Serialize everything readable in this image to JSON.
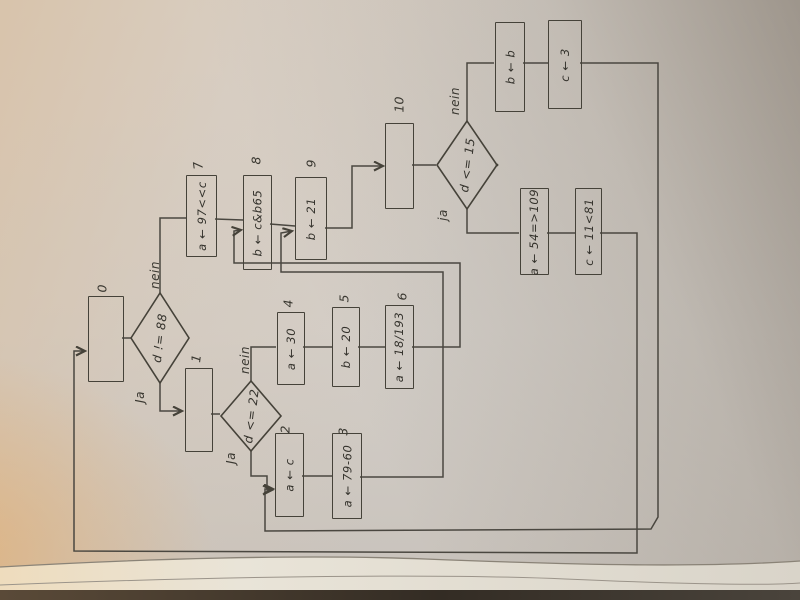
{
  "colors": {
    "ink": "#454239",
    "paper": "#d3cec8"
  },
  "flowchart": {
    "decisions": {
      "d1": {
        "text": "d != 88",
        "yes": "Ja",
        "no": "nein"
      },
      "d2": {
        "text": "d <= 22",
        "yes": "Ja",
        "no": "nein"
      },
      "d3": {
        "text": "d <= 15",
        "yes": "ja",
        "no": "nein"
      }
    },
    "boxes": {
      "b0": {
        "num": "0",
        "text": ""
      },
      "b1": {
        "num": "1",
        "text": ""
      },
      "b2": {
        "num": "2",
        "text": "a ← c"
      },
      "b3": {
        "num": "3",
        "text": "a ← 79-60"
      },
      "b4": {
        "num": "4",
        "text": "a ← 30"
      },
      "b5": {
        "num": "5",
        "text": "b ← 20"
      },
      "b6": {
        "num": "6",
        "text": "a ← 18/193"
      },
      "b7": {
        "num": "7",
        "text": "a ← 97<<c"
      },
      "b8": {
        "num": "8",
        "text": "b ← c&b65"
      },
      "b9": {
        "num": "9",
        "text": "b ← 21"
      },
      "b10": {
        "num": "10",
        "text": ""
      },
      "b11": {
        "text": "b ← b"
      },
      "b12": {
        "text": "c ← 3"
      },
      "b13": {
        "text": "a ← 54=>109"
      },
      "b14": {
        "text": "c ← 11<81"
      }
    }
  }
}
